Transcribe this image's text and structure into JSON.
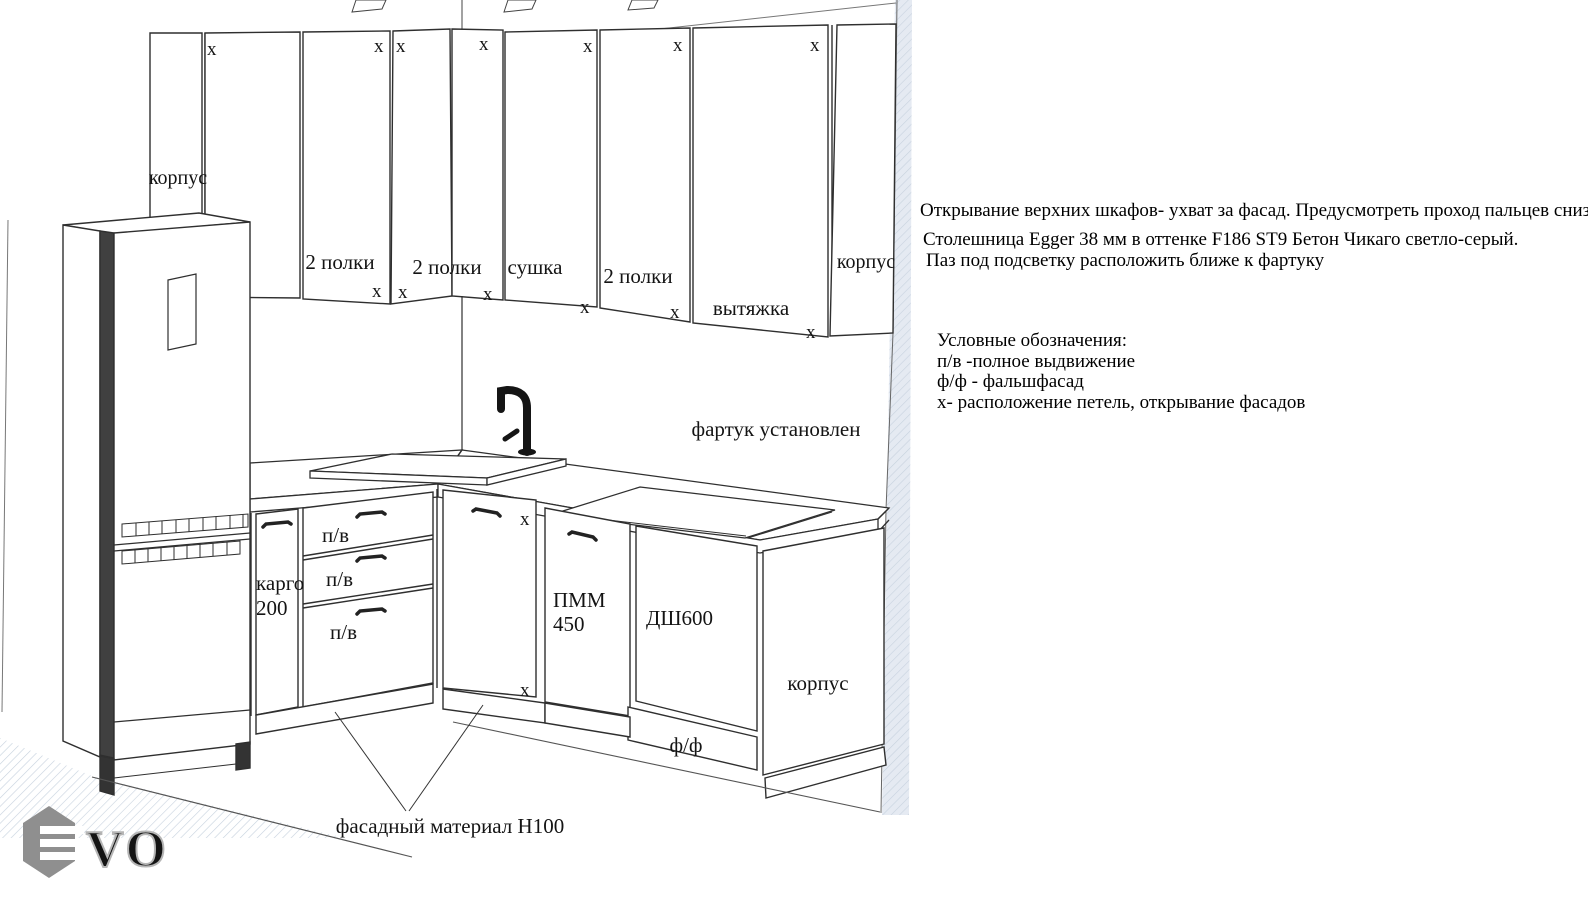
{
  "colors": {
    "line": "#2f2f2f",
    "wall_strip": "#e5eaf2",
    "hatch": "#c7d2de",
    "logo_gray": "#8f8f8f",
    "faucet_black": "#151515"
  },
  "diagram": {
    "hinge_mark": "x",
    "upper_cabinets": {
      "left_panel": "корпус",
      "door_left_wall": "2 полки",
      "corner_double_door": "2 полки",
      "dryer_door": "сушка",
      "door_right_wall": "2 полки",
      "hood_door": "вытяжка",
      "right_panel": "корпус"
    },
    "lower_cabinets": {
      "cargo_line1": "карго",
      "cargo_line2": "200",
      "drawer1": "п/в",
      "drawer2": "п/в",
      "drawer3": "п/в",
      "pmm_line1": "ПММ",
      "pmm_line2": "450",
      "oven_cabinet": "ДШ600",
      "false_front": "ф/ф",
      "end_panel": "корпус"
    },
    "backsplash_note": "фартук установлен",
    "plinth_callout": "фасадный материал Н100"
  },
  "notes": {
    "note1": "Открывание верхних шкафов- ухват за фасад. Предусмотреть проход пальцев снизу.",
    "note2": "Столешница Egger 38 мм в оттенке F186 ST9 Бетон Чикаго светло-серый.",
    "note3": "Паз под подсветку расположить ближе к фартуку"
  },
  "legend": {
    "title": "Условные обозначения:",
    "items": [
      "п/в -полное выдвижение",
      "ф/ф - фальшфасад",
      "х- расположение петель, открывание фасадов"
    ]
  },
  "logo": {
    "vo": "VO"
  }
}
